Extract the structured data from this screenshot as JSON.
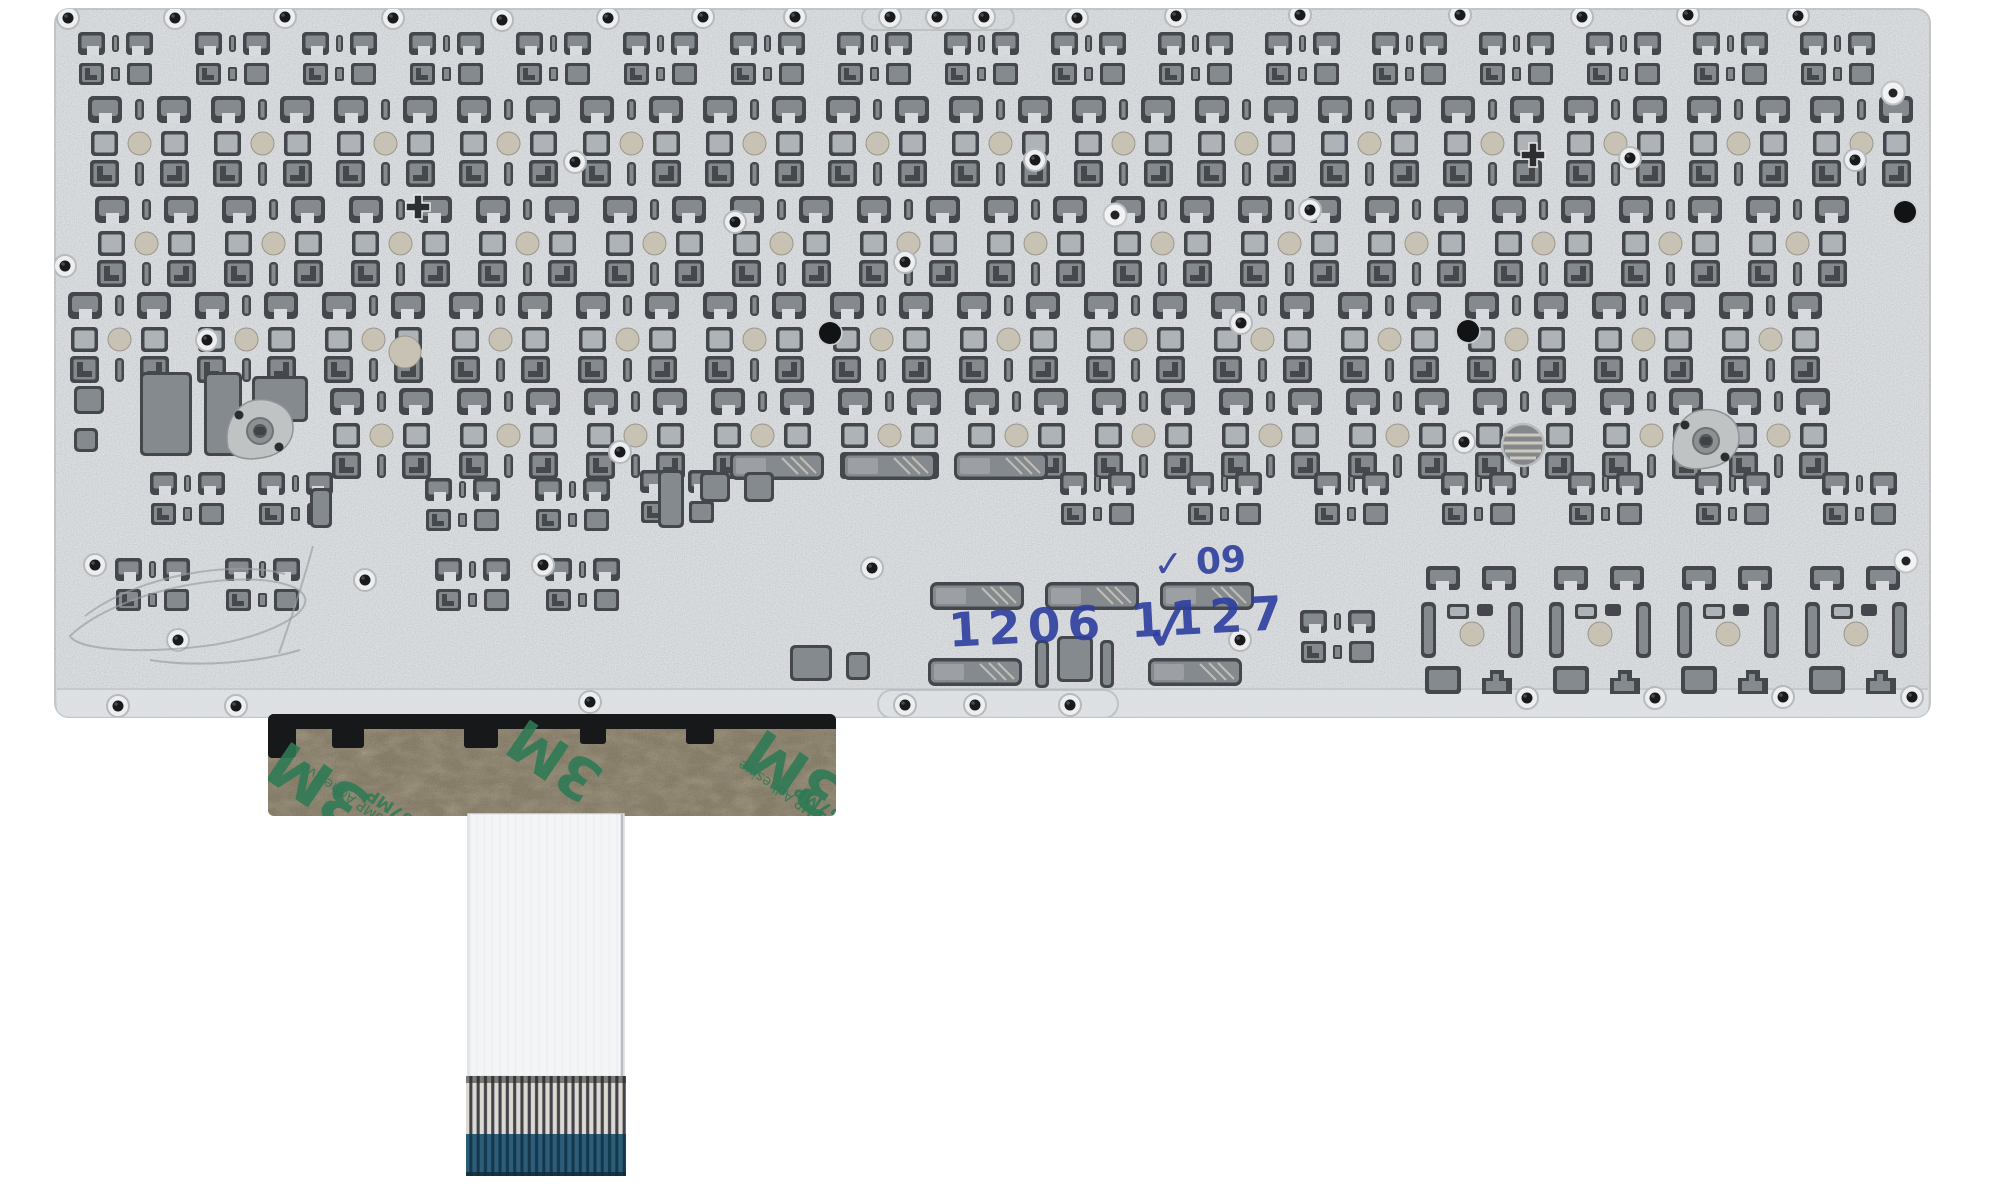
{
  "meta": {
    "subject": "laptop keyboard metal backplate, rear view product photo",
    "background": "#ffffff"
  },
  "palette": {
    "plate": "#d8dbde",
    "plate_edge": "#c2c6c9",
    "cut_dark": "#44484c",
    "cut_mid": "#858a8f",
    "cut_light": "#aeb3b7",
    "dome": "#c8c2b4",
    "ink": "#2e3f9f",
    "adhesive_base": "#a39a84",
    "adhesive_print": "#2e7a55",
    "cable_white": "#f3f5f7",
    "cable_stiffener": "#2d5d78"
  },
  "markings": {
    "lot_small": "✓ 09",
    "lot_code": "1206 1127",
    "checkmark": "✓"
  },
  "adhesive": {
    "brand": "3M",
    "spec_mp": "200MP Adhesive",
    "spec": "467MP"
  },
  "plate": {
    "rows": [
      {
        "sym": "cs",
        "y": 32,
        "x0": 195,
        "pitch": 107,
        "count": 16
      },
      {
        "sym": "cf",
        "y": 96,
        "x0": 88,
        "pitch": 123,
        "count": 15
      },
      {
        "sym": "cf",
        "y": 196,
        "x0": 95,
        "pitch": 127,
        "count": 14
      },
      {
        "sym": "cf",
        "y": 292,
        "x0": 68,
        "pitch": 127,
        "count": 14
      },
      {
        "sym": "cf",
        "y": 388,
        "x0": 330,
        "pitch": 127,
        "count": 12
      },
      {
        "sym": "cs",
        "y": 472,
        "x0": 1060,
        "pitch": 127,
        "count": 7
      }
    ],
    "singles": [
      [
        "cs",
        78,
        32
      ],
      [
        "cs",
        150,
        472
      ],
      [
        "cs",
        258,
        472
      ],
      [
        "cs",
        425,
        478
      ],
      [
        "cs",
        535,
        478
      ],
      [
        "cs",
        640,
        470
      ],
      [
        "cs",
        115,
        558
      ],
      [
        "cs",
        225,
        558
      ],
      [
        "cs",
        435,
        558
      ],
      [
        "cs",
        545,
        558
      ],
      [
        "cs",
        1300,
        610
      ],
      [
        "cb",
        1420,
        566
      ],
      [
        "cb",
        1548,
        566
      ],
      [
        "cb",
        1676,
        566
      ],
      [
        "cb",
        1804,
        566
      ]
    ],
    "slots": [
      [
        730,
        452
      ],
      [
        842,
        452
      ],
      [
        954,
        452
      ],
      [
        930,
        582
      ],
      [
        1045,
        582
      ],
      [
        1160,
        582
      ],
      [
        928,
        658
      ],
      [
        1148,
        658
      ]
    ],
    "bars": [
      [
        1035,
        640,
        14,
        48
      ],
      [
        1057,
        636,
        36,
        46
      ],
      [
        1100,
        640,
        14,
        48
      ],
      [
        140,
        372,
        52,
        84
      ],
      [
        204,
        372,
        38,
        84
      ],
      [
        252,
        376,
        56,
        46
      ],
      [
        74,
        386,
        30,
        28
      ],
      [
        74,
        428,
        24,
        24
      ],
      [
        790,
        645,
        42,
        36
      ],
      [
        846,
        652,
        24,
        28
      ],
      [
        658,
        470,
        26,
        58
      ],
      [
        310,
        488,
        22,
        40
      ],
      [
        700,
        472,
        30,
        30
      ],
      [
        744,
        472,
        30,
        30
      ]
    ],
    "screws": [
      [
        68,
        18
      ],
      [
        175,
        18
      ],
      [
        285,
        17
      ],
      [
        393,
        18
      ],
      [
        502,
        20
      ],
      [
        608,
        18
      ],
      [
        703,
        17
      ],
      [
        795,
        17
      ],
      [
        890,
        17
      ],
      [
        937,
        17
      ],
      [
        984,
        17
      ],
      [
        1077,
        18
      ],
      [
        1176,
        16
      ],
      [
        1300,
        15
      ],
      [
        1460,
        15
      ],
      [
        1582,
        17
      ],
      [
        1688,
        15
      ],
      [
        1798,
        16
      ],
      [
        575,
        162
      ],
      [
        1035,
        160
      ],
      [
        1630,
        158
      ],
      [
        1855,
        160
      ],
      [
        735,
        222
      ],
      [
        1310,
        210
      ],
      [
        65,
        266
      ],
      [
        905,
        262
      ],
      [
        1241,
        323
      ],
      [
        207,
        340
      ],
      [
        1464,
        442
      ],
      [
        620,
        452
      ],
      [
        95,
        565
      ],
      [
        365,
        580
      ],
      [
        543,
        565
      ],
      [
        872,
        568
      ],
      [
        178,
        640
      ],
      [
        1240,
        640
      ],
      [
        118,
        706
      ],
      [
        236,
        706
      ],
      [
        590,
        702
      ],
      [
        905,
        705
      ],
      [
        975,
        705
      ],
      [
        1070,
        705
      ],
      [
        1527,
        698
      ],
      [
        1655,
        698
      ],
      [
        1783,
        697
      ],
      [
        1912,
        697
      ]
    ],
    "rings": [
      [
        1115,
        215
      ],
      [
        1906,
        561
      ],
      [
        1893,
        93
      ]
    ],
    "big_dots": [
      [
        830,
        333
      ],
      [
        1905,
        212
      ],
      [
        1468,
        331
      ]
    ],
    "crosses": [
      [
        418,
        207
      ],
      [
        1533,
        155
      ]
    ],
    "hatch_holes": [
      [
        1523,
        445
      ]
    ],
    "big_domes": [
      [
        405,
        352
      ]
    ],
    "hinges": [
      [
        226,
        398
      ],
      [
        1672,
        408
      ]
    ],
    "grooves": [
      [
        862,
        6,
        152,
        24
      ],
      [
        878,
        690,
        240,
        28
      ]
    ],
    "top_nubs": [
      [
        742,
        0
      ],
      [
        1102,
        0
      ],
      [
        1418,
        0
      ],
      [
        1628,
        0
      ]
    ],
    "scratches": [
      "M70,636 C120,588 250,566 295,588 C330,606 270,638 205,646 C140,654 78,650 70,636 Z",
      "M85,616 C140,574 235,560 285,574",
      "M313,546 C302,586 290,622 279,653",
      "M150,660 C200,668 260,662 300,650"
    ]
  }
}
